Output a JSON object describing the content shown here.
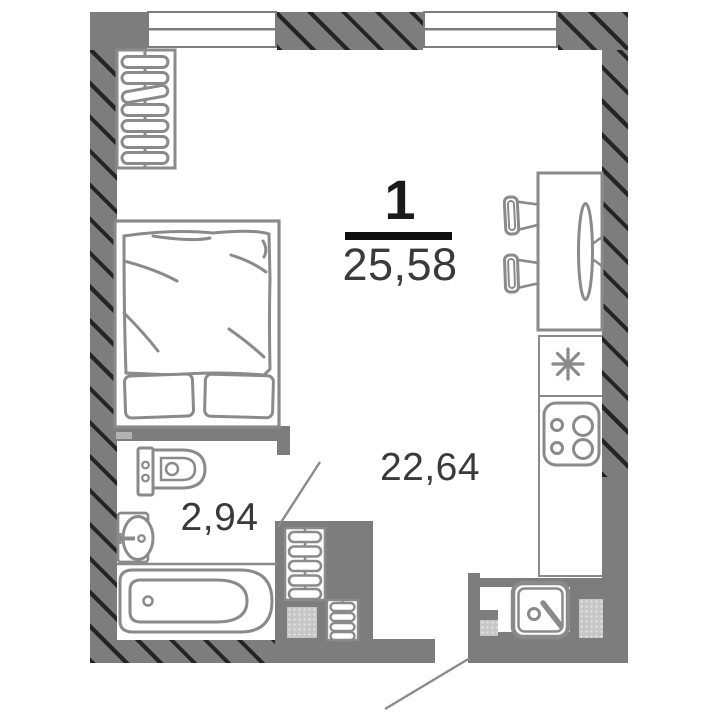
{
  "floorplan": {
    "rooms_count": "1",
    "total_area": "25,58",
    "main_area": "22,64",
    "bathroom_area": "2,94",
    "colors": {
      "wall": "#7d7d7d",
      "hatch": "#242424",
      "furniture_outline": "#8a8a8a",
      "fraction_line": "#0f0f0f",
      "rooms_number_text": "#1a1a1a",
      "area_text": "#3a3a3a",
      "vent_shaft_fill": "#c6c6c6",
      "background": "#ffffff"
    },
    "symbols": [
      "window",
      "radiator",
      "double-bed",
      "toilet",
      "wash-basin",
      "bathtub",
      "dining-table",
      "chair",
      "wall-tv",
      "refrigerator-snowflake",
      "stove-4-burners",
      "kitchen-sink",
      "vent-shaft",
      "door-swing",
      "entrance-leader-line"
    ]
  }
}
